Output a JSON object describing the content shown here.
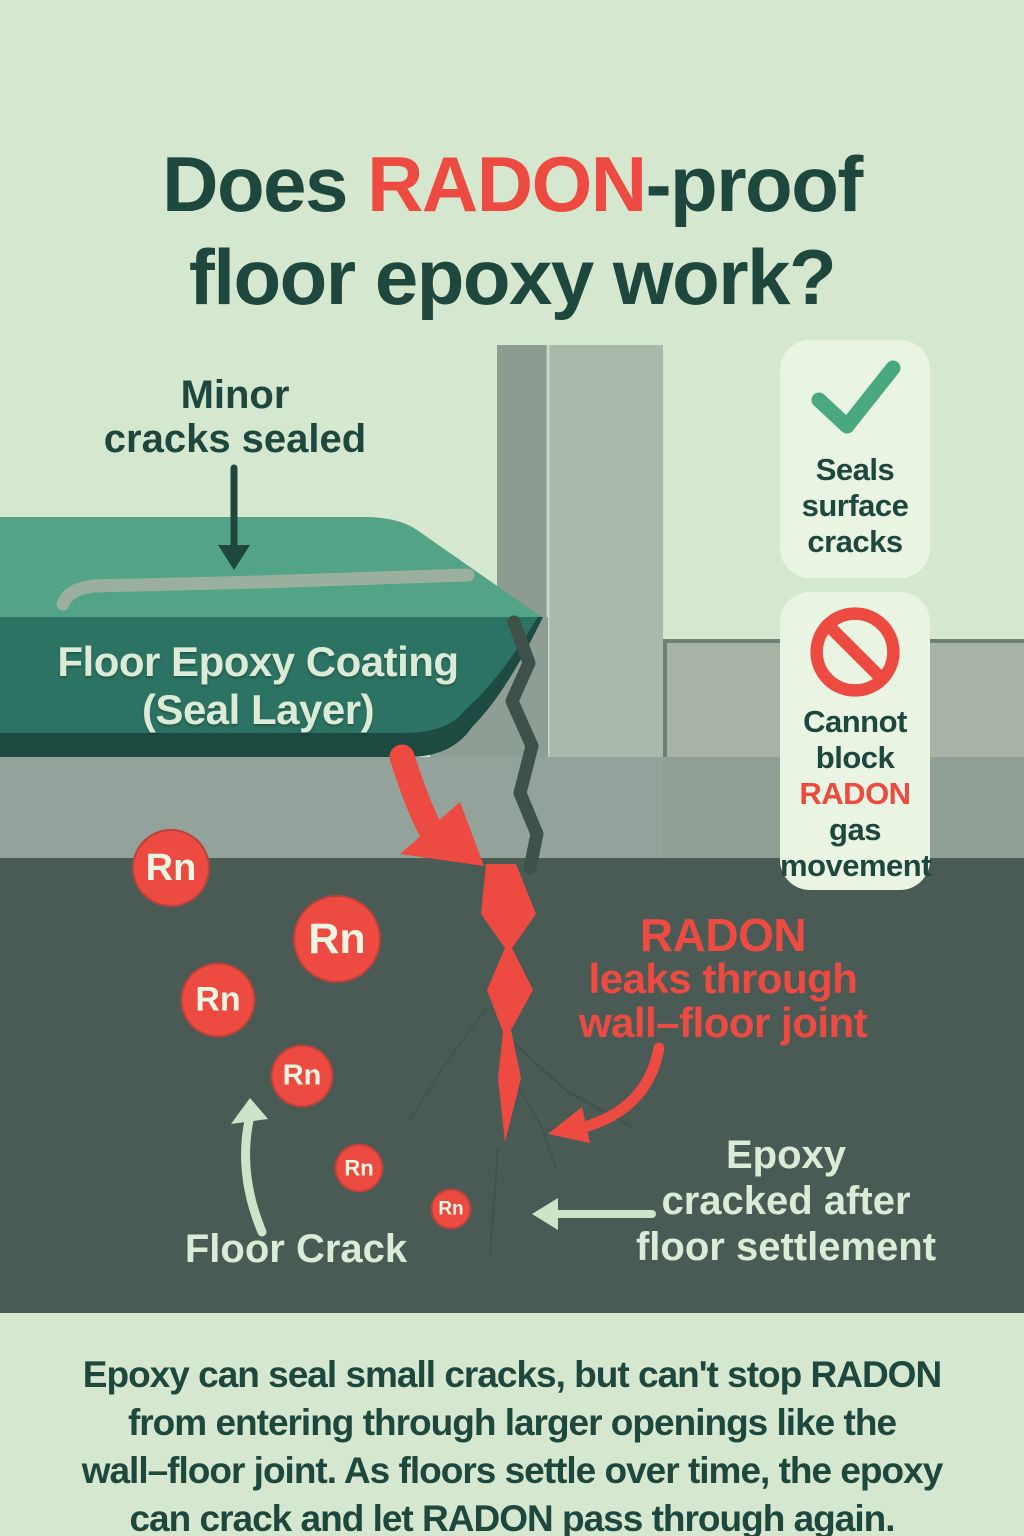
{
  "title": {
    "part1": "Does ",
    "highlight": "RADON",
    "part2": "-proof",
    "line2": "floor epoxy work?"
  },
  "annotations": {
    "minor_cracks": {
      "line1": "Minor",
      "line2": "cracks sealed"
    },
    "epoxy_coating": {
      "line1": "Floor Epoxy Coating",
      "line2": "(Seal Layer)"
    },
    "radon_leak": {
      "line1": "RADON",
      "line2": "leaks through",
      "line3": "wall–floor joint"
    },
    "epoxy_cracked": {
      "line1": "Epoxy",
      "line2": "cracked after",
      "line3": "floor settlement"
    },
    "floor_crack": "Floor Crack"
  },
  "badges": {
    "seals": {
      "icon": "check-icon",
      "line1": "Seals",
      "line2": "surface",
      "line3": "cracks"
    },
    "cannot": {
      "icon": "prohibited-icon",
      "line1": "Cannot",
      "line2": "block",
      "line3": "RADON",
      "line4": "gas",
      "line5": "movement"
    }
  },
  "molecules": {
    "symbol": "Rn",
    "count": 6
  },
  "footer": {
    "line1": "Epoxy can seal small cracks, but can't stop RADON",
    "line2": "from entering through larger openings like the",
    "line3": "wall–floor joint. As floors settle over time, the epoxy",
    "line4": "can crack and let RADON pass through again."
  },
  "colors": {
    "background": "#d5e7cf",
    "title_green": "#1e473d",
    "accent_red": "#ed4b41",
    "epoxy_top": "#53a486",
    "epoxy_front": "#2c7363",
    "epoxy_shadow": "#1d4a41",
    "floor_gray": "#93a29a",
    "soil": "#4a5b55",
    "wall_side": "#8d9b91",
    "wall_front": "#abb8ac",
    "footing_gray": "#a7b4a5",
    "card_bg": "#e9f4e2",
    "check_green": "#4aa87f",
    "cream": "#dcebd6",
    "sealed_crack_gray": "#a2b0a0",
    "crack_dark": "#3f514b"
  }
}
